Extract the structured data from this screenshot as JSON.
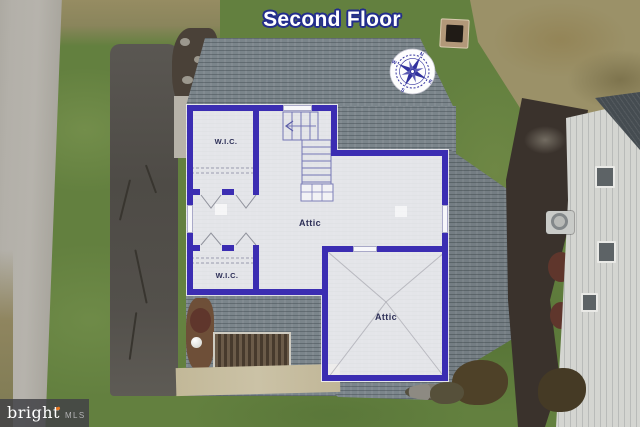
{
  "title": "Second Floor",
  "rooms": {
    "wic_upper": "W.I.C.",
    "wic_lower": "W.I.C.",
    "attic_main": "Attic",
    "attic_secondary": "Attic"
  },
  "compass": {
    "n": "N",
    "e": "E",
    "s": "S",
    "w": "W"
  },
  "watermark": {
    "brand": "bright",
    "suffix": "MLS"
  },
  "colors": {
    "plan_wall": "#3b2db2",
    "title_fill": "#ffffff",
    "title_outline": "#232d8c",
    "room_label": "#2e3058",
    "compass_ink": "#32329e",
    "logo_accent": "#e87722",
    "overlay_fill": "rgba(244,244,247,0.87)"
  }
}
